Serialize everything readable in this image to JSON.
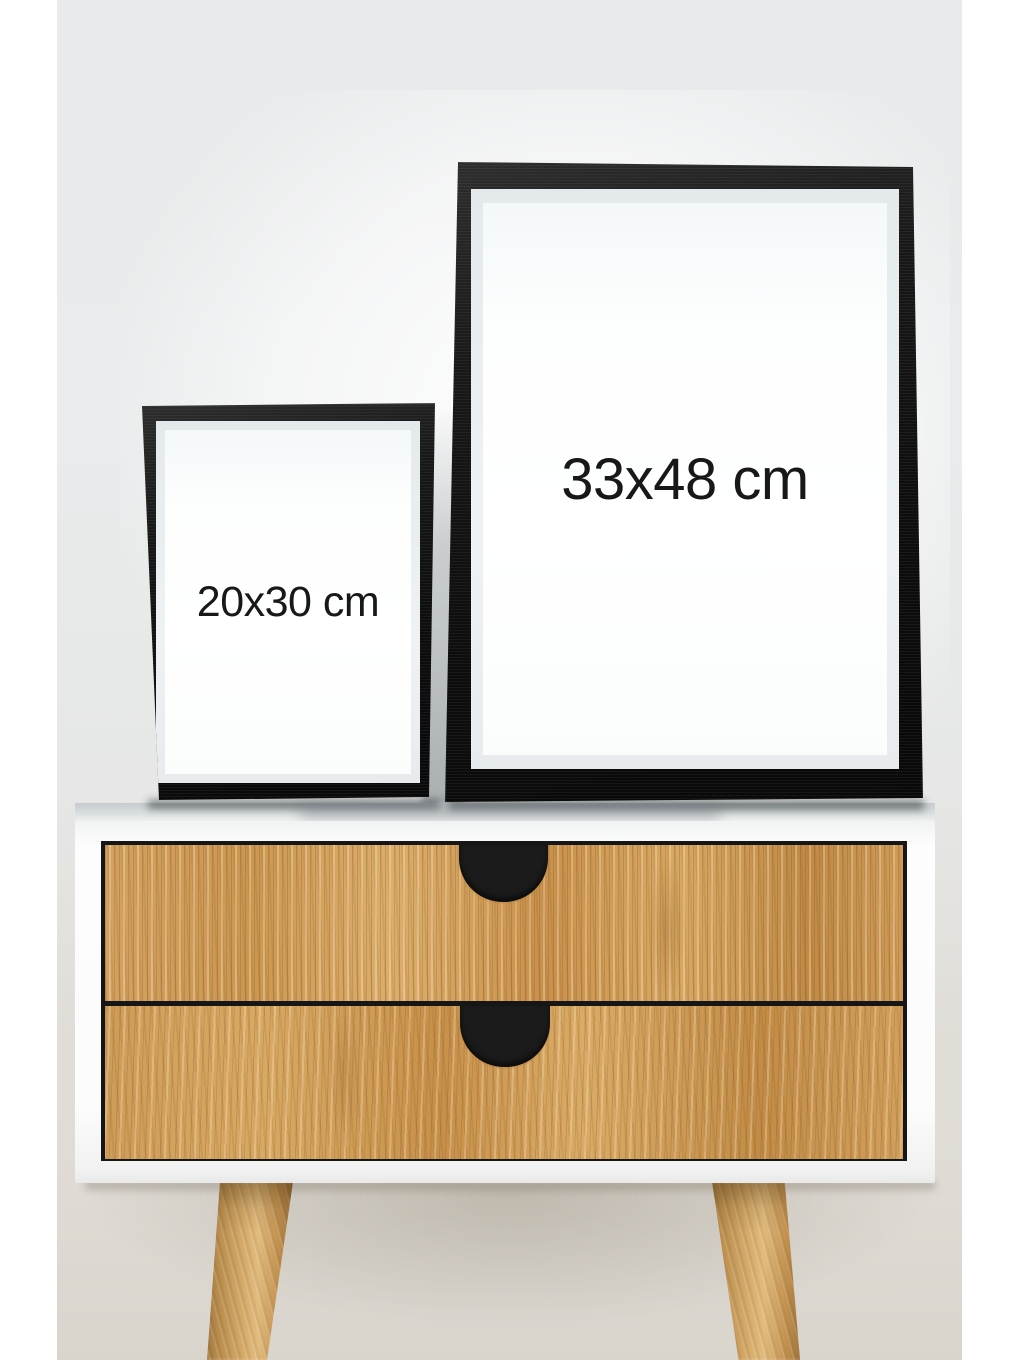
{
  "product_photo": {
    "frames": {
      "large": {
        "size_label": "33x48 cm"
      },
      "small": {
        "size_label": "20x30 cm"
      }
    },
    "colors": {
      "canvas_margin": "#ffffff",
      "wall_top": "#e8eaeb",
      "wall_glow": "#fdfefe",
      "wall_bottom": "#d9d5cd",
      "frame_black": "#111111",
      "frame_mat": "#eef2f4",
      "frame_inner_white": "#ffffff",
      "label_text": "#18181a",
      "cabinet_white": "#fcfcfc",
      "cabinet_top_shade": "#c6cbcd",
      "drawer_opening_dark": "#161616",
      "wood_light": "#dcae6b",
      "wood_mid": "#cb9750",
      "wood_dark": "#a87838",
      "handle_dark": "#1b1b1b",
      "leg_wood": "#c3924f"
    }
  }
}
